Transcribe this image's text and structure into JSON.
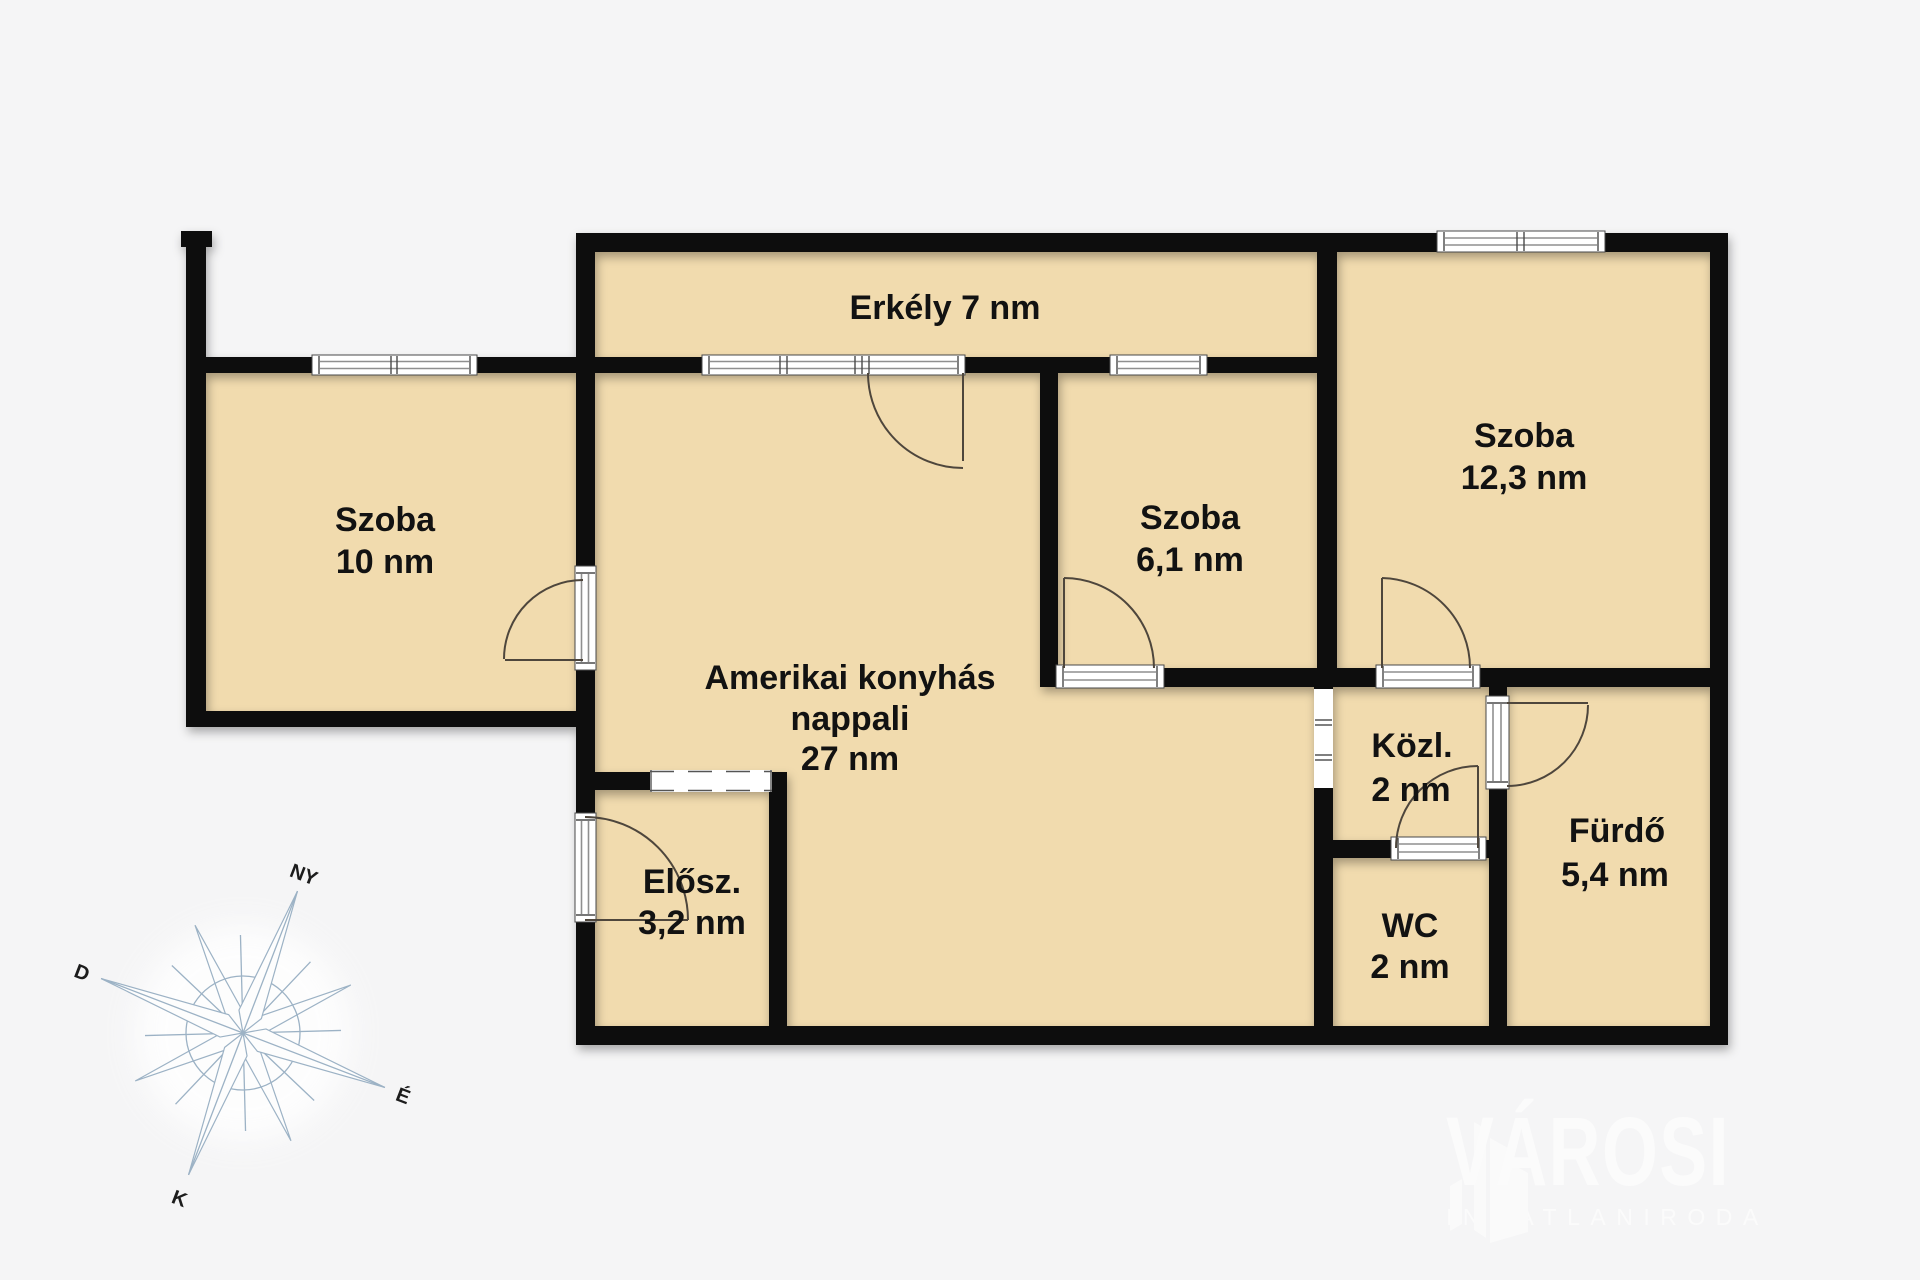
{
  "colors": {
    "background": "#f5f5f6",
    "floor": "#f1dbae",
    "wall": "#070707",
    "window": "#ffffff",
    "door-arc": "#4e463c",
    "label": "#121212",
    "compass-line": "#9cb2c5",
    "logo-text": "#fbfbfb"
  },
  "rooms": {
    "erkely": {
      "label": "Erkély 7 nm"
    },
    "szoba10": {
      "name": "Szoba",
      "area": "10 nm"
    },
    "nappali": {
      "line1": "Amerikai konyhás",
      "line2": "nappali",
      "line3": "27 nm"
    },
    "szoba61": {
      "name": "Szoba",
      "area": "6,1 nm"
    },
    "szoba123": {
      "name": "Szoba",
      "area": "12,3 nm"
    },
    "elosz": {
      "name": "Elősz.",
      "area": "3,2 nm"
    },
    "kozl": {
      "name": "Közl.",
      "area": "2 nm"
    },
    "wc": {
      "name": "WC",
      "area": "2 nm"
    },
    "furdo": {
      "name": "Fürdő",
      "area": "5,4 nm"
    }
  },
  "compass": {
    "ny": "NY",
    "d": "D",
    "eszak": "É",
    "k": "K"
  },
  "logo": {
    "brand": "VÁROSI",
    "subtitle": "INGATLANIRODA"
  }
}
